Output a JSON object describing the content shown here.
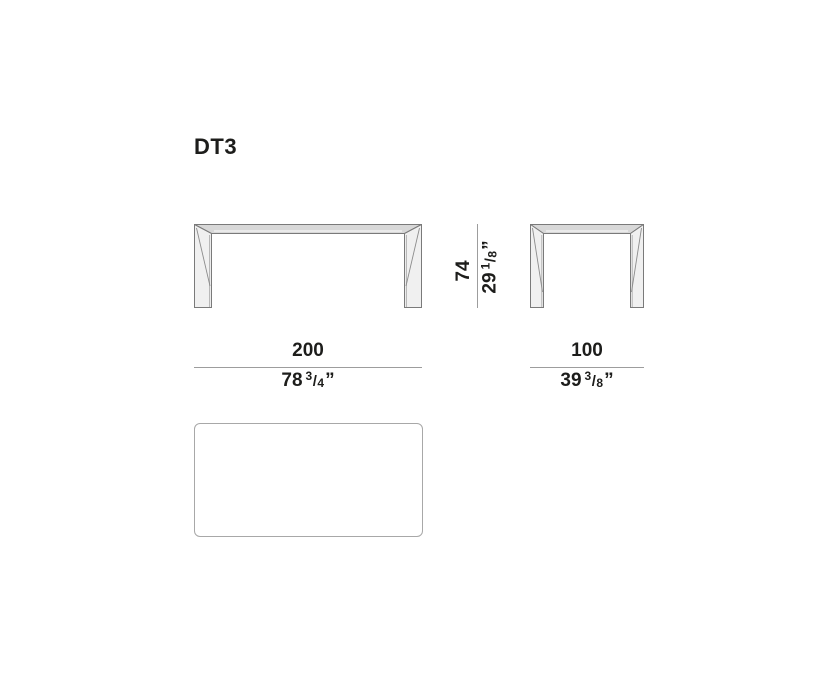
{
  "title": "DT3",
  "colors": {
    "text": "#1d1d1b",
    "dimension_line": "#9d9d9d",
    "drawing_outline": "#7a7a7a",
    "tabletop_fill": "#d8d8d8",
    "leg_fill": "#f0f0f0",
    "background": "#ffffff"
  },
  "height_dimension": {
    "cm": "74",
    "inches_whole": "29",
    "inches_numerator": "1",
    "fraction_slash": "/",
    "inches_denominator": "8",
    "inches_unit": "”"
  },
  "front_width_dimension": {
    "cm": "200",
    "inches_whole": "78",
    "inches_numerator": "3",
    "fraction_slash": "/",
    "inches_denominator": "4",
    "inches_unit": "”"
  },
  "side_width_dimension": {
    "cm": "100",
    "inches_whole": "39",
    "inches_numerator": "3",
    "fraction_slash": "/",
    "inches_denominator": "8",
    "inches_unit": "”"
  }
}
